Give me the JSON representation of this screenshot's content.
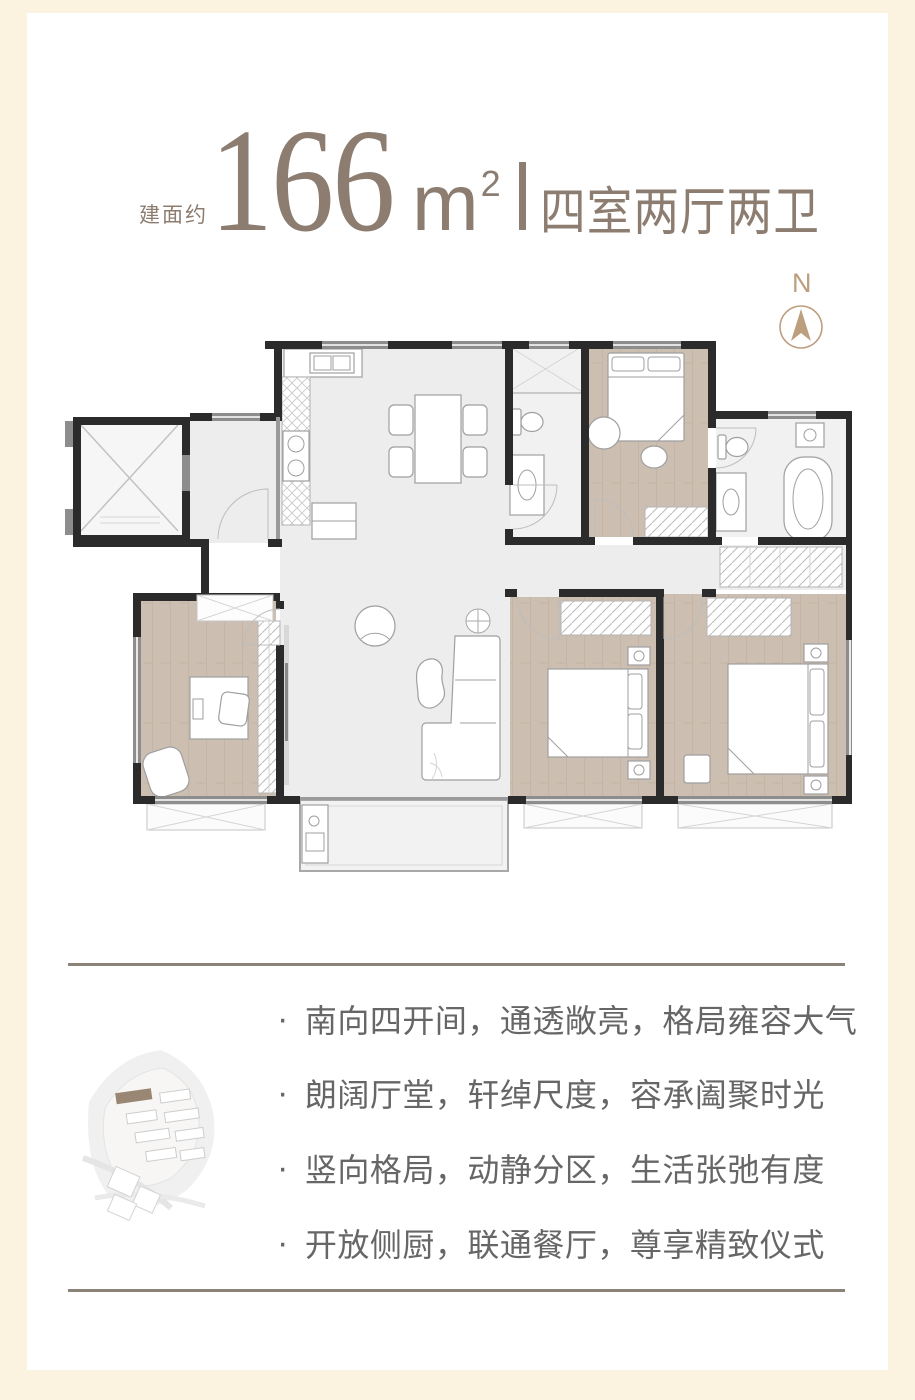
{
  "colors": {
    "page_bg": "#fcf2e0",
    "card_bg": "#ffffff",
    "title_taupe": "#8c7d70",
    "compass_tan": "#bd9e7e",
    "feature_text": "#666666",
    "divider": "#8b8377",
    "wall_dark": "#2b2b2b",
    "wall_gray": "#8d8d8d",
    "floor_light": "#ededed",
    "wood": "#ccbeb0",
    "map_highlight": "#8f7a64"
  },
  "header": {
    "area_prefix": "建面约",
    "area_number": "166",
    "area_unit": "m",
    "area_exponent": "2",
    "layout_label": "四室两厅两卫"
  },
  "compass": {
    "label": "N"
  },
  "features": {
    "bullet": "·",
    "items": [
      "南向四开间，通透敞亮，格局雍容大气",
      "朗阔厅堂，轩绰尺度，容承阖聚时光",
      "竖向格局，动静分区，生活张弛有度",
      "开放侧厨，联通餐厅，尊享精致仪式"
    ]
  }
}
